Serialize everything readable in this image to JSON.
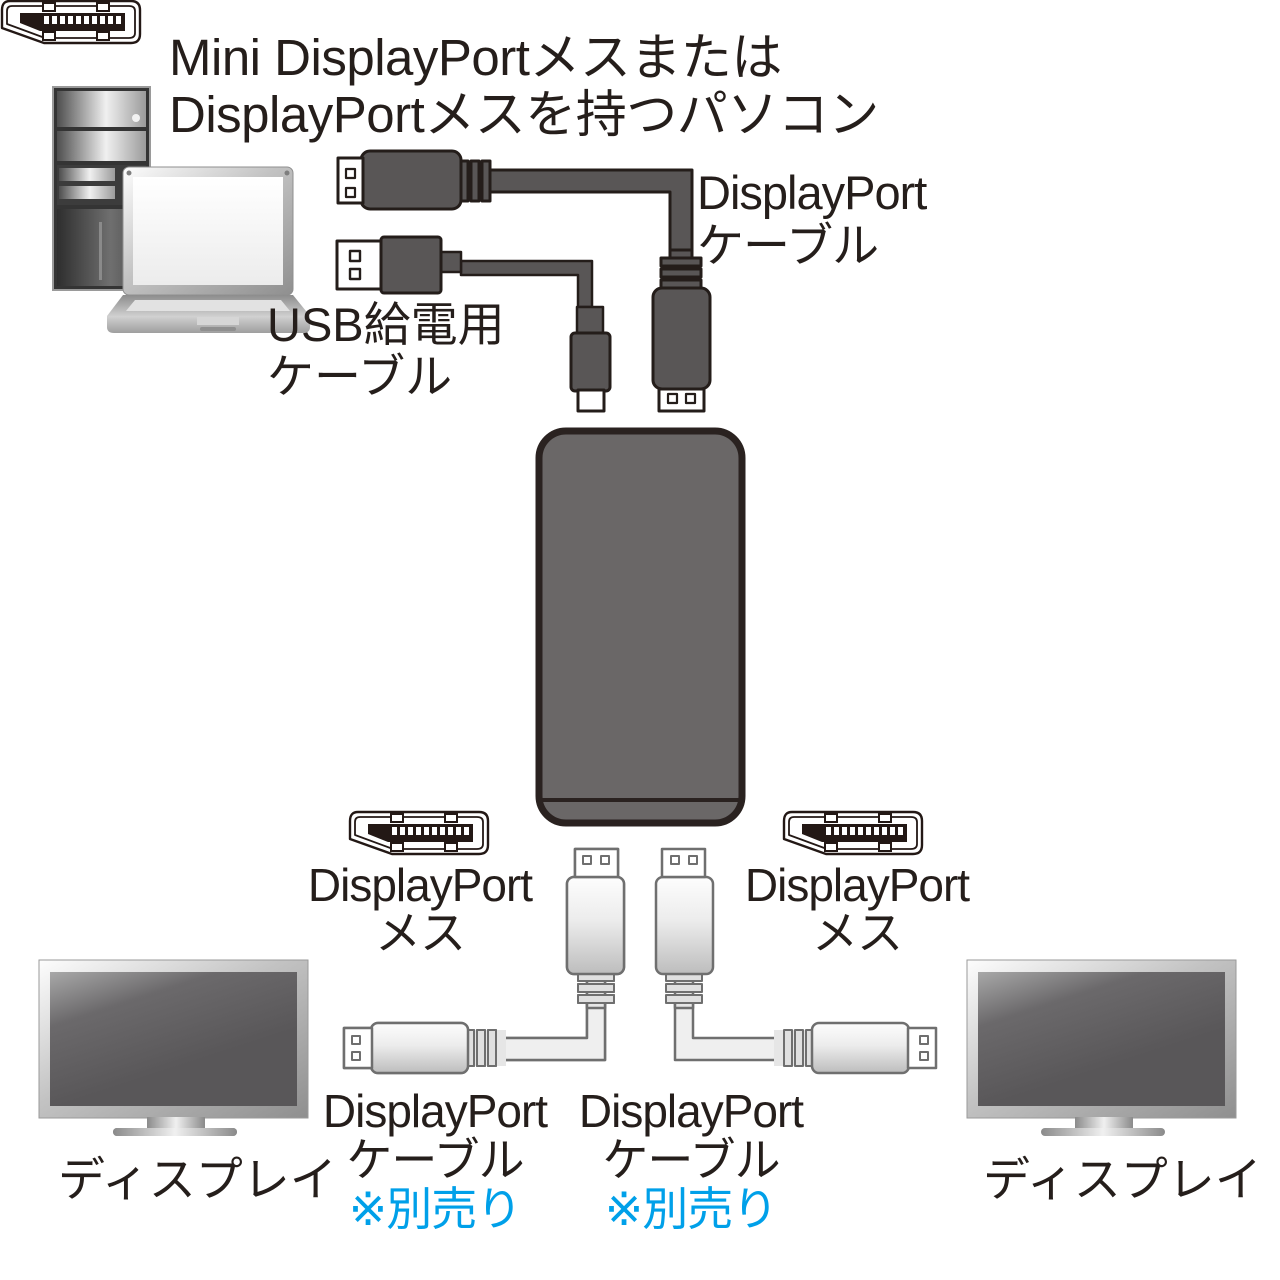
{
  "colors": {
    "background": "#ffffff",
    "text": "#251e1b",
    "note_blue": "#00a0e9",
    "cable_dark_fill": "#595656",
    "cable_dark_outline": "#241d1a",
    "hub_fill": "#6a6767",
    "hub_outline": "#2a2220",
    "light_cable_outline": "#6f6f6f"
  },
  "icons": {
    "desktop-pc-icon": "desktop tower illustration",
    "laptop-icon": "laptop illustration",
    "displayport-cable-top-icon": "dark DisplayPort cable plugging into hub top",
    "usb-power-cable-icon": "dark USB power cable plugging into hub top",
    "mst-hub-icon": "MST hub device body",
    "displayport-female-port-icon": "DisplayPort receptacle pictogram",
    "displayport-cable-bottom-icon": "light DisplayPort cable to display",
    "display-monitor-icon": "monitor illustration"
  },
  "labels": {
    "heading": {
      "line1": "Mini DisplayPortメスまたは",
      "line2": "DisplayPortメスを持つパソコン"
    },
    "dp_cable_top": {
      "line1": "DisplayPort",
      "line2": "ケーブル"
    },
    "usb_cable": {
      "line1": "USB給電用",
      "line2": "ケーブル"
    },
    "dp_female_left": {
      "line1": "DisplayPort",
      "line2": "メス"
    },
    "dp_female_right": {
      "line1": "DisplayPort",
      "line2": "メス"
    },
    "dp_cable_bottom_left": {
      "line1": "DisplayPort",
      "line2": "ケーブル",
      "note": "※別売り"
    },
    "dp_cable_bottom_right": {
      "line1": "DisplayPort",
      "line2": "ケーブル",
      "note": "※別売り"
    },
    "display_left": "ディスプレイ",
    "display_right": "ディスプレイ"
  }
}
